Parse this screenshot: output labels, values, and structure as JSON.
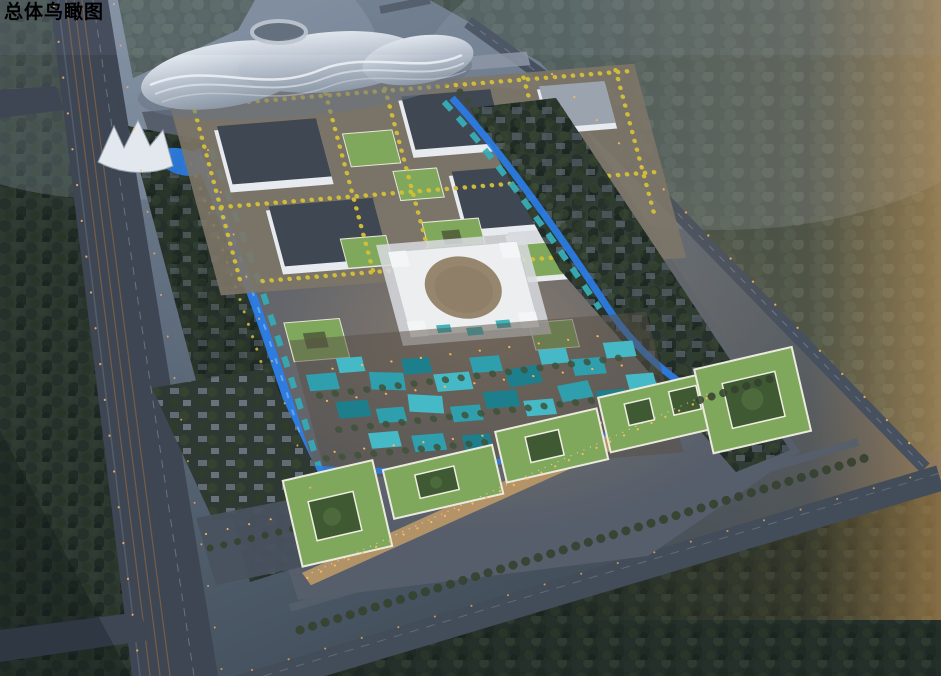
{
  "title": "总体鸟瞰图",
  "palette": {
    "water": "#2b7de6",
    "water_light": "#6fb0f2",
    "teal_roof": "#2f9fae",
    "teal_roof_light": "#45bac6",
    "teal_roof_dark": "#1d7f8c",
    "green_roof": "#7fa85c",
    "green_roof_dark": "#3f5a33",
    "campus_roof_dark": "#3f4752",
    "building_white": "#e7eaee",
    "yellow_tree": "#d4c137",
    "forest": "#2a352d",
    "road": "#414b59",
    "rail": "#7c5f45",
    "warm_light": "#ffb85c",
    "plaza": "#c9a066",
    "dome_roof": "#96866e"
  }
}
